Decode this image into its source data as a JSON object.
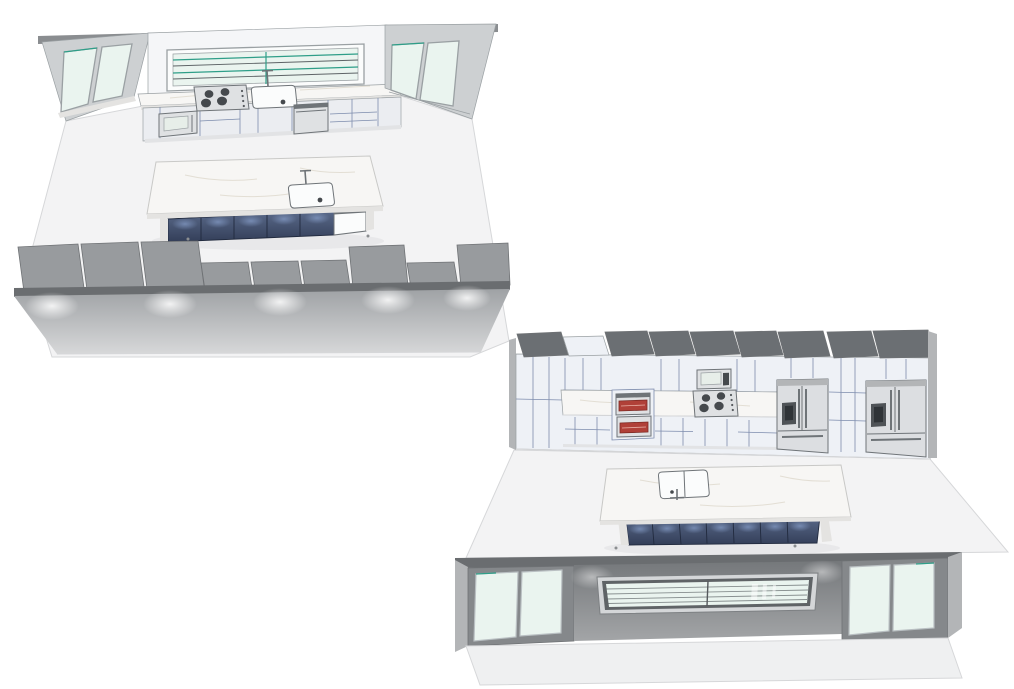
{
  "page": {
    "background": "#ffffff",
    "description": "Two 3D renderings of the same kitchen design, viewed from opposite corners"
  },
  "colors": {
    "bg": "#ffffff",
    "floor": "#f3f3f4",
    "floorEdge": "#d6d7d9",
    "ceiling": "#8a8d90",
    "sideWall": "#cdd0d2",
    "backWall": "#f5f6f8",
    "glass": "#eaf4ef",
    "glassFrame": "#9aa0a3",
    "teal": "#2e9e88",
    "slatDark": "#5d6366",
    "marble": "#f7f6f4",
    "marbleEdge": "#e4e3e1",
    "vein": "#e0dbd0",
    "cabinet": "#eef1f6",
    "cabinetLine": "#7d8cad",
    "baseCab": "#ebedf1",
    "steel": "#dfe1e3",
    "steelDark": "#6f7478",
    "burner": "#45494d",
    "navyTop": "#5a6a8a",
    "navyBot": "#333e58",
    "navyLine": "#212a3e",
    "navyGlow": "#91aad7",
    "grayBlock": "#989b9e",
    "grayBlockLine": "#6f7275",
    "band": "#6a6d70",
    "wallATop": "#9fa2a5",
    "wallABot": "#d7d8d9",
    "slabB": "#6b6f73",
    "wallBTop": "#75787b",
    "wallBBot": "#a3a5a7",
    "doorFrame": "#85888b",
    "cap": "#b3b5b7",
    "fridge": "#dcdee1",
    "fridgeDark": "#8f9396",
    "ovenRed": "#b04038",
    "ovenRedDark": "#7e2a24",
    "screen": "#e7eee9",
    "outerFloor": "#eff0f1",
    "shadow": "#e2e3e5",
    "applianceWhite": "#fbfcfc"
  },
  "views": [
    {
      "label": "kitchen-render-window-wall-view",
      "position": "top-left",
      "components": [
        "sliding-glass-door-left",
        "range-window-with-blinds",
        "gas-cooktop-4-burner",
        "wall-sink-with-faucet",
        "built-in-microwave",
        "dishwasher",
        "sliding-glass-door-right",
        "marble-countertop",
        "kitchen-island",
        "island-sink-with-faucet",
        "island-dishwasher-panel",
        "navy-island-cabinets",
        "cutaway-wall-with-cabinet-backs",
        "wall-wash-lighting"
      ],
      "cooktop_burners": 4,
      "light_glow_count": 5
    },
    {
      "label": "kitchen-render-appliance-wall-view",
      "position": "bottom-right",
      "components": [
        "tall-pantry-cabinets",
        "double-wall-oven",
        "built-in-microwave",
        "gas-cooktop-4-burner",
        "french-door-refrigerator-left",
        "french-door-refrigerator-right",
        "marble-countertop",
        "kitchen-island",
        "island-double-sink-with-faucet",
        "navy-island-cabinets",
        "cutaway-front-wall",
        "picture-window-with-blinds",
        "sliding-glass-door-left",
        "sliding-glass-door-right"
      ],
      "cooktop_burners": 4,
      "refrigerator_count": 2
    }
  ]
}
